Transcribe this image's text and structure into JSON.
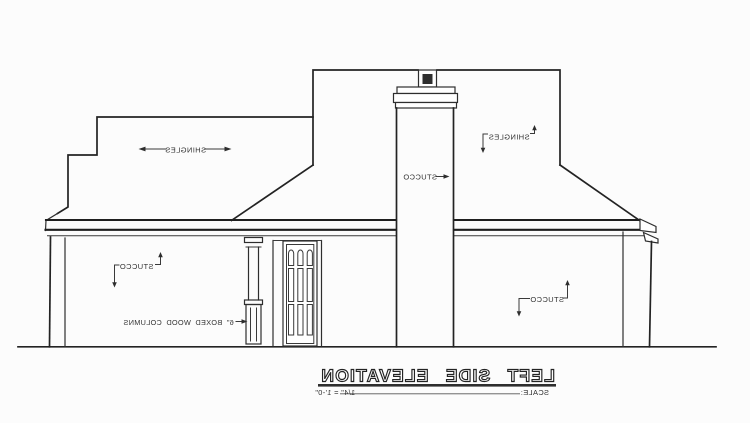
{
  "sheet": {
    "background": "#fcfcfc",
    "line_color": "#2e2e2e",
    "flue_color": "#161616"
  },
  "labels": {
    "shingles_left": "SHINGLES",
    "shingles_right": "SHINGLES",
    "stucco_chimney": "STUCCO",
    "stucco_left_wall": "STUCCO",
    "stucco_right_wall": "STUCCO",
    "boxed_wood_columns": "6\" BOXED WOOD COLUMNS"
  },
  "title_block": {
    "title": "LEFT SIDE ELEVATION",
    "scale_label": "SCALE:",
    "scale_value": "1/4\" = 1'-0\""
  }
}
